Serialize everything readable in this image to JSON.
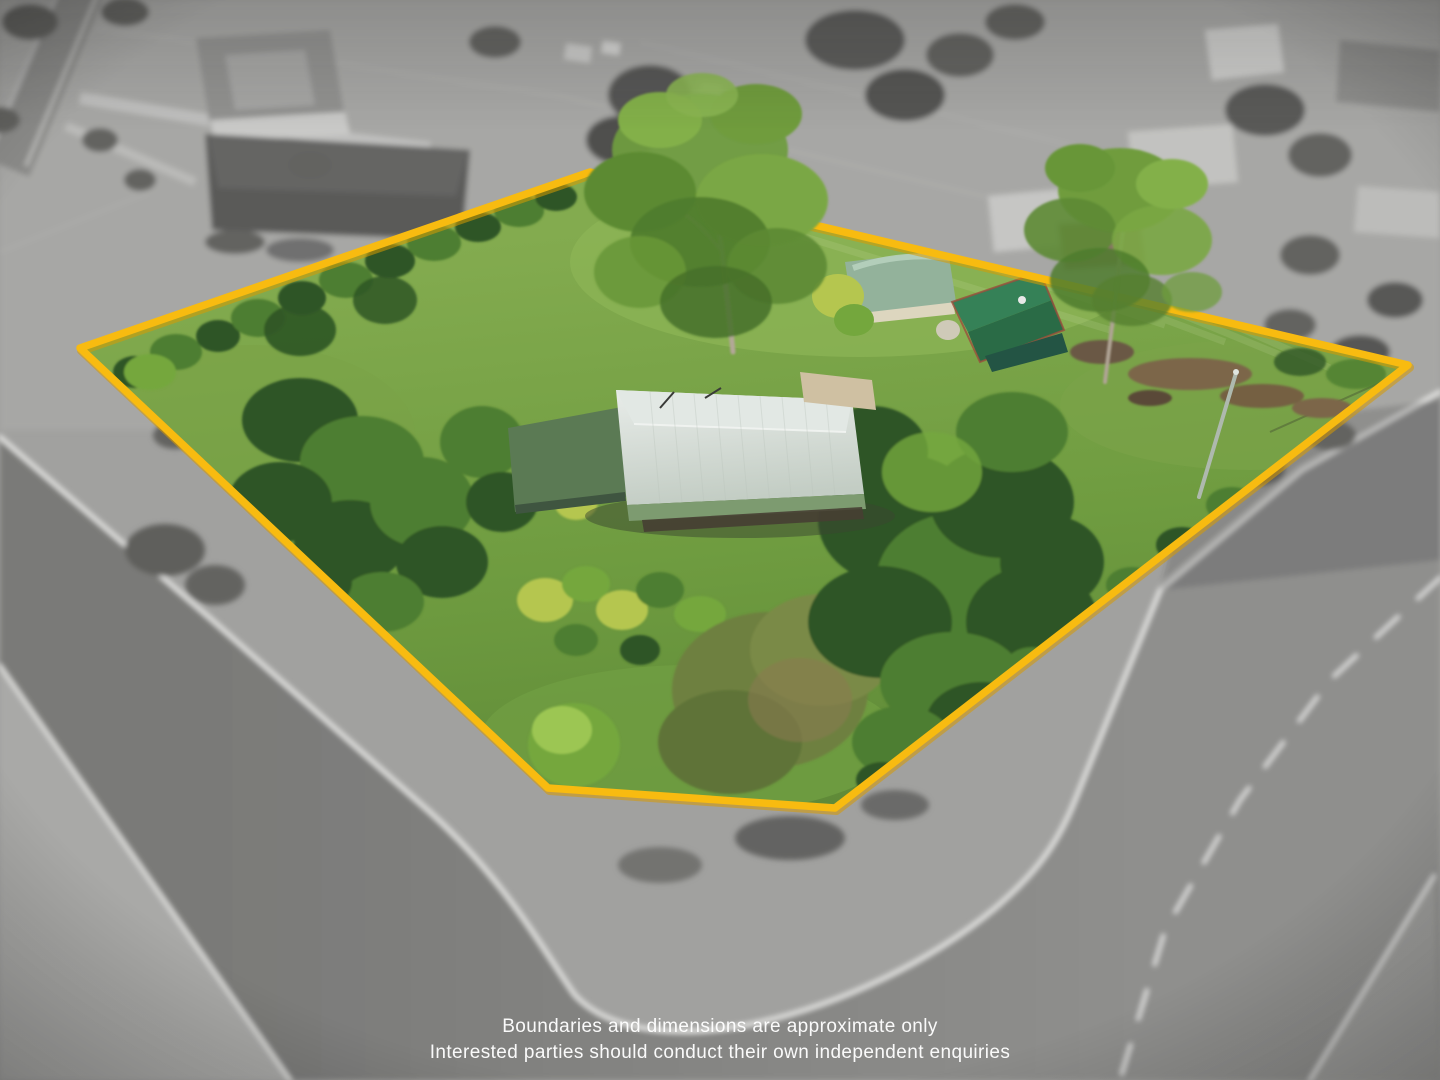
{
  "image": {
    "kind": "aerial-drone-property-photo",
    "width": 1440,
    "height": 1080,
    "effect": "surroundings desaturated and blurred, property in colour with highlighted boundary"
  },
  "disclaimer": {
    "line1": "Boundaries and dimensions are approximate only",
    "line2": "Interested parties should conduct their own independent enquiries"
  },
  "boundary": {
    "vertices": "590,172 1408,365 835,808 548,788 80,348",
    "stroke_width": 7.5
  },
  "palette": {
    "boundary": "#F8BB10",
    "boundary_shadow": "#D89A00",
    "text": "#FFFFFF",
    "bg_gray": "#A1A19F",
    "road_dark": "#7E7E7C",
    "road_mid": "#8C8C8A",
    "verge_gray": "#A9A9A7",
    "marking": "#E9E9E7",
    "gray_tree": "#636361",
    "lawn": "#6F9C40",
    "lawn_light": "#8CB455",
    "tree_dark": "#2F5526",
    "tree_mid": "#4E7E30",
    "tree_light": "#74A73D",
    "tree_yellow": "#B5C64F",
    "trunk": "#B3A798",
    "house_roof_light": "#E8ECE9",
    "house_roof_dark": "#C3CDC4",
    "veranda_green": "#7D9B70",
    "house_section_green": "#5B7A54",
    "carport_tan": "#CFC0A2",
    "shed1_roof": "#93B29B",
    "shed1_wall": "#DDD6BF",
    "shed2_roof": "#2F7D53",
    "shed2_trim": "#9A4F3C",
    "dirt": "#7B6648"
  }
}
